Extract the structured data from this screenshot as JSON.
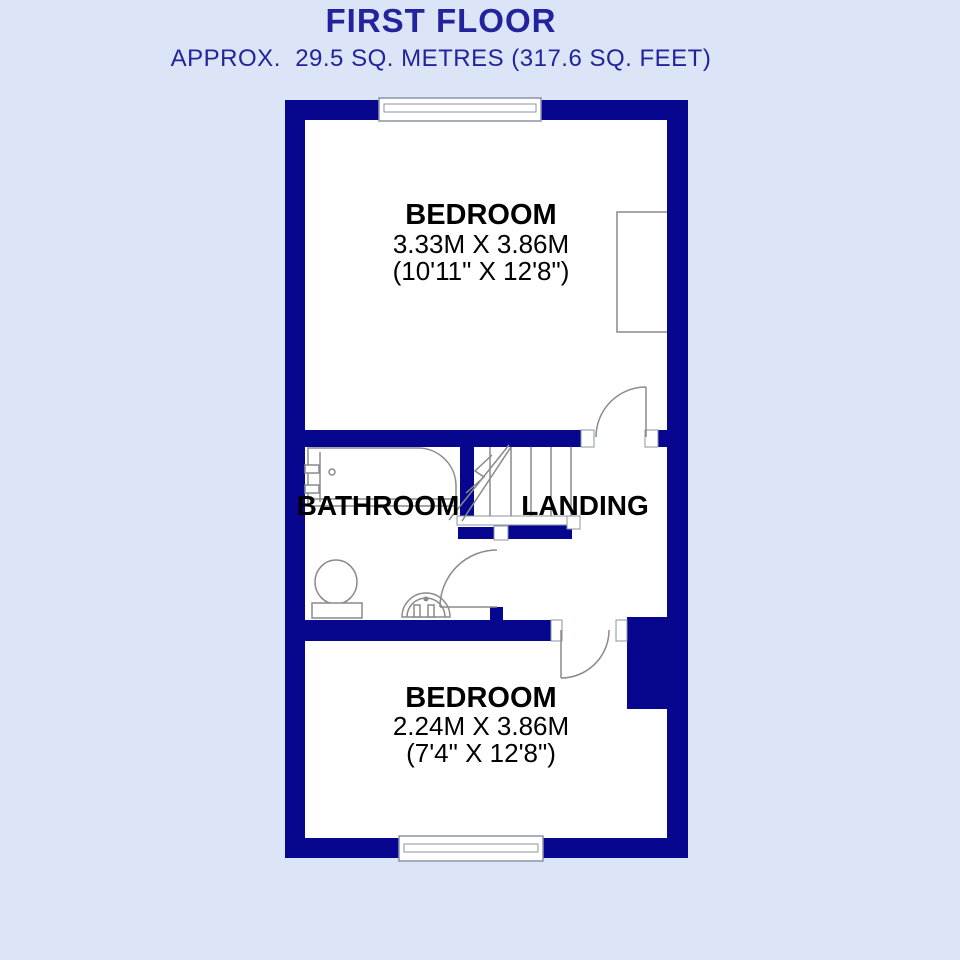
{
  "header": {
    "title": "FIRST FLOOR",
    "subtitle": "APPROX.  29.5 SQ. METRES (317.6 SQ. FEET)"
  },
  "rooms": {
    "bedroom1": {
      "name": "BEDROOM",
      "dimensions_metric": "3.33M X 3.86M",
      "dimensions_imperial": "(10'11\" X 12'8\")"
    },
    "bedroom2": {
      "name": "BEDROOM",
      "dimensions_metric": "2.24M X 3.86M",
      "dimensions_imperial": "(7'4\" X 12'8\")"
    },
    "bathroom": {
      "name": "BATHROOM"
    },
    "landing": {
      "name": "LANDING"
    }
  },
  "colors": {
    "background": "#dbe5f7",
    "floor": "#ffffff",
    "wall": "#06068f",
    "header_text": "#23239b",
    "room_text": "#000000",
    "fixture_outline": "#8a8a8a",
    "window_outline": "#8b93a5"
  }
}
